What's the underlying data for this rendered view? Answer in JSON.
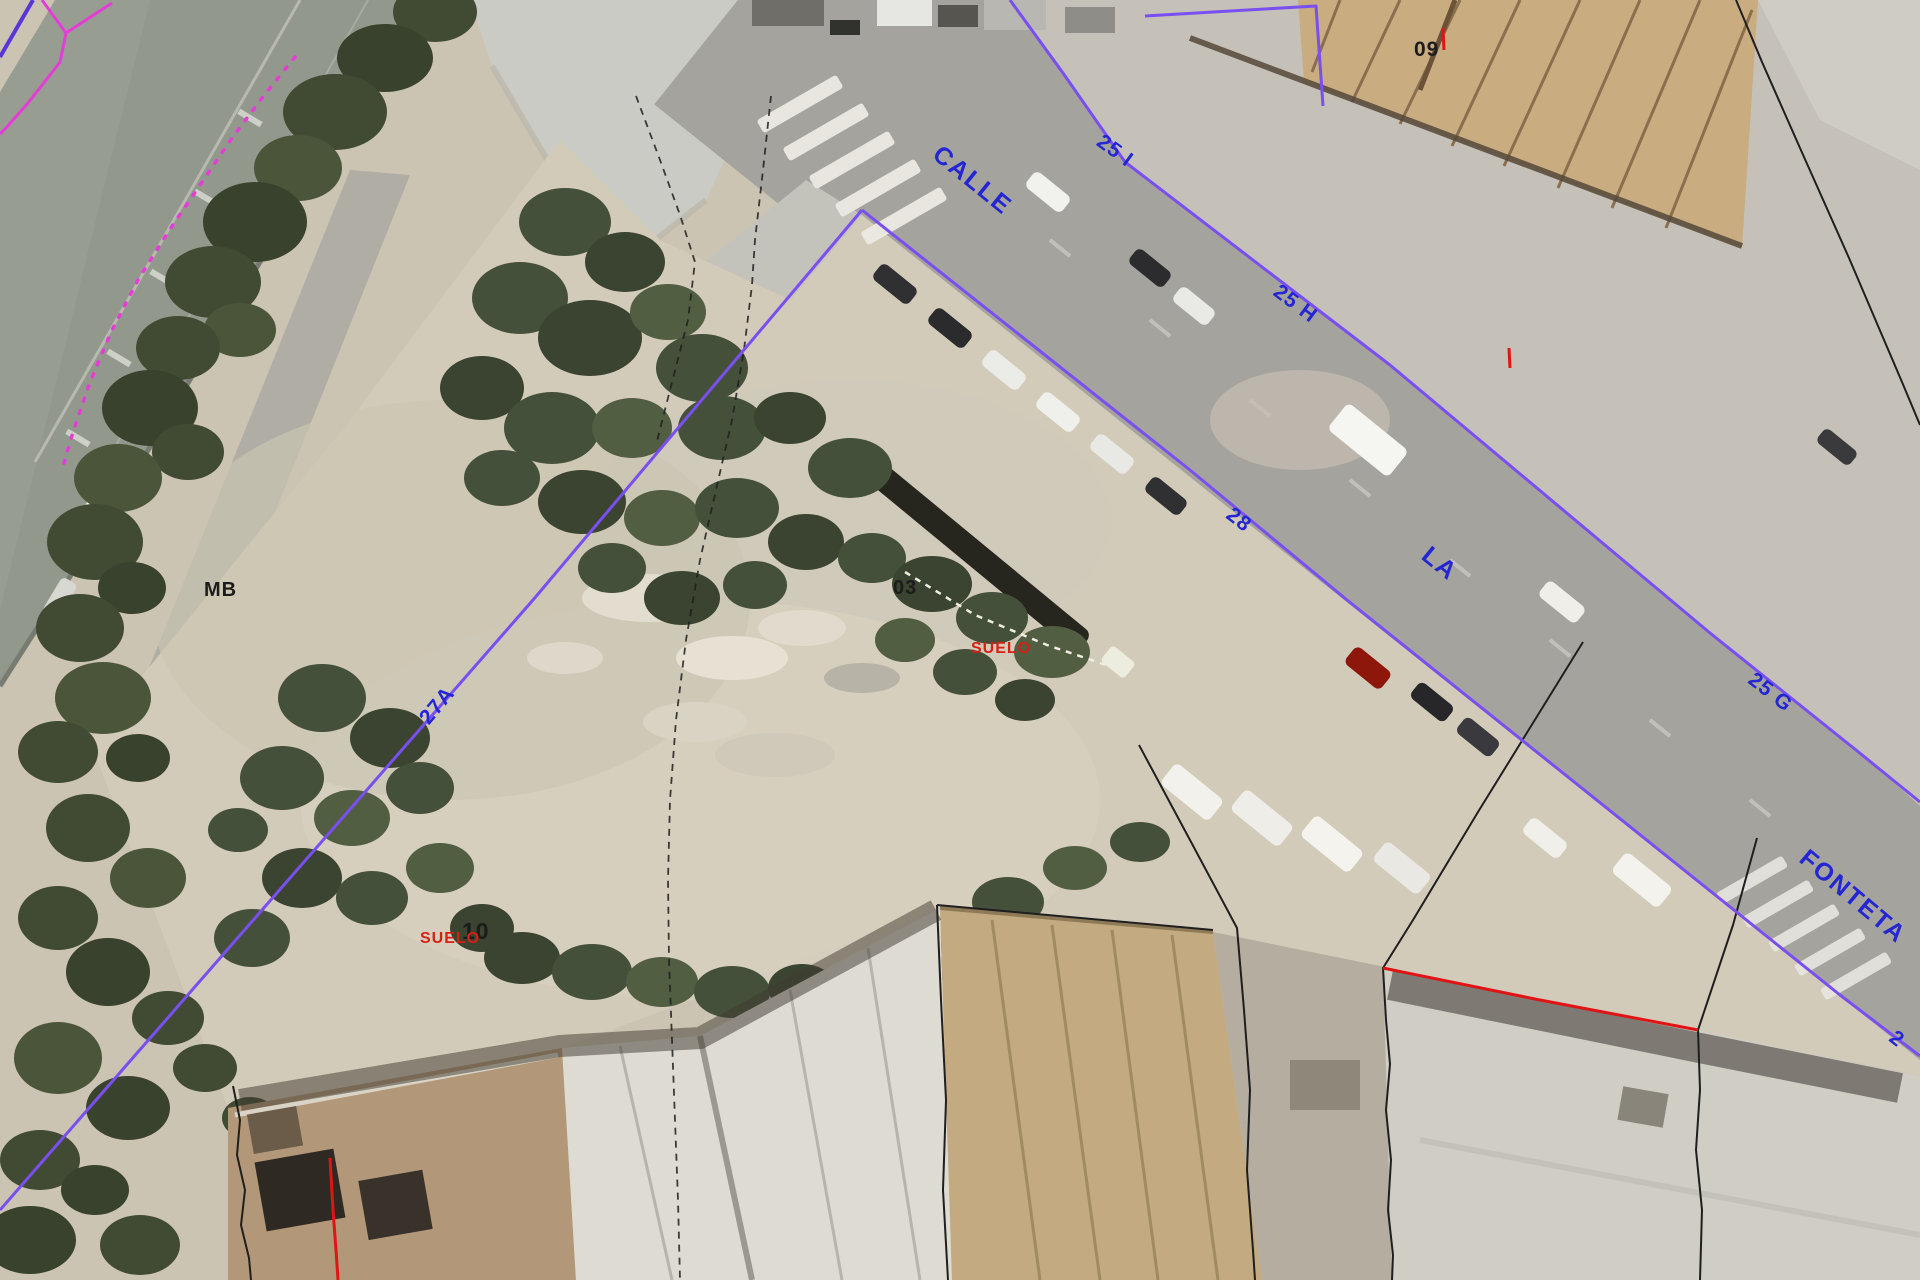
{
  "map": {
    "street_name_parts": {
      "calle": "CALLE",
      "la": "LA",
      "fonteta": "FONTETA"
    },
    "parcel_numbers": {
      "n25i": "25 I",
      "n25h": "25 H",
      "n25g": "25 G",
      "n28": "28",
      "n27a": "27A",
      "edge_partial": "2"
    },
    "building_codes": {
      "b09": "09",
      "b03": "03",
      "b10": "10",
      "mb": "MB"
    },
    "land_use": {
      "suelo_a": "SUELO",
      "suelo_b": "SUELO"
    },
    "colors": {
      "parcel_line": "#7a4ff0",
      "street_label": "#2326d2",
      "black_label": "#1c1c1c",
      "black_line": "#1f1f1f",
      "suelo_red": "#d81f14",
      "red_line": "#e01414",
      "magenta_line": "#e53cd8",
      "blue_corner_line": "#5a35d8"
    }
  }
}
